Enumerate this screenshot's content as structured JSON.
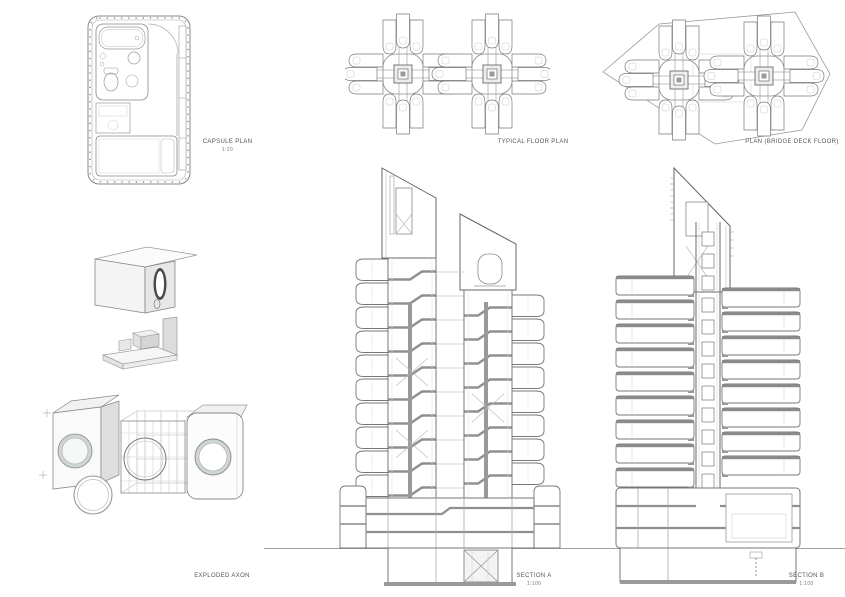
{
  "page": {
    "background": "#ffffff"
  },
  "colors": {
    "line_dark": "#666666",
    "line_mid": "#8a8a8a",
    "line_light": "#bbbbbb",
    "slab_poche": "#8f8f8f",
    "porthole_fill": "#cdd6d2",
    "label_text": "#555555"
  },
  "drawings": {
    "capsule_plan": {
      "label": "CAPSULE PLAN",
      "scale": "1:20"
    },
    "typical_floor_plan": {
      "label": "TYPICAL FLOOR PLAN"
    },
    "bridge_deck_plan": {
      "label": "PLAN (BRIDGE DECK FLOOR)"
    },
    "exploded_axon": {
      "label": "EXPLODED AXON"
    },
    "section_a": {
      "label": "SECTION A",
      "scale": "1:100"
    },
    "section_b": {
      "label": "SECTION B",
      "scale": "1:100"
    }
  }
}
